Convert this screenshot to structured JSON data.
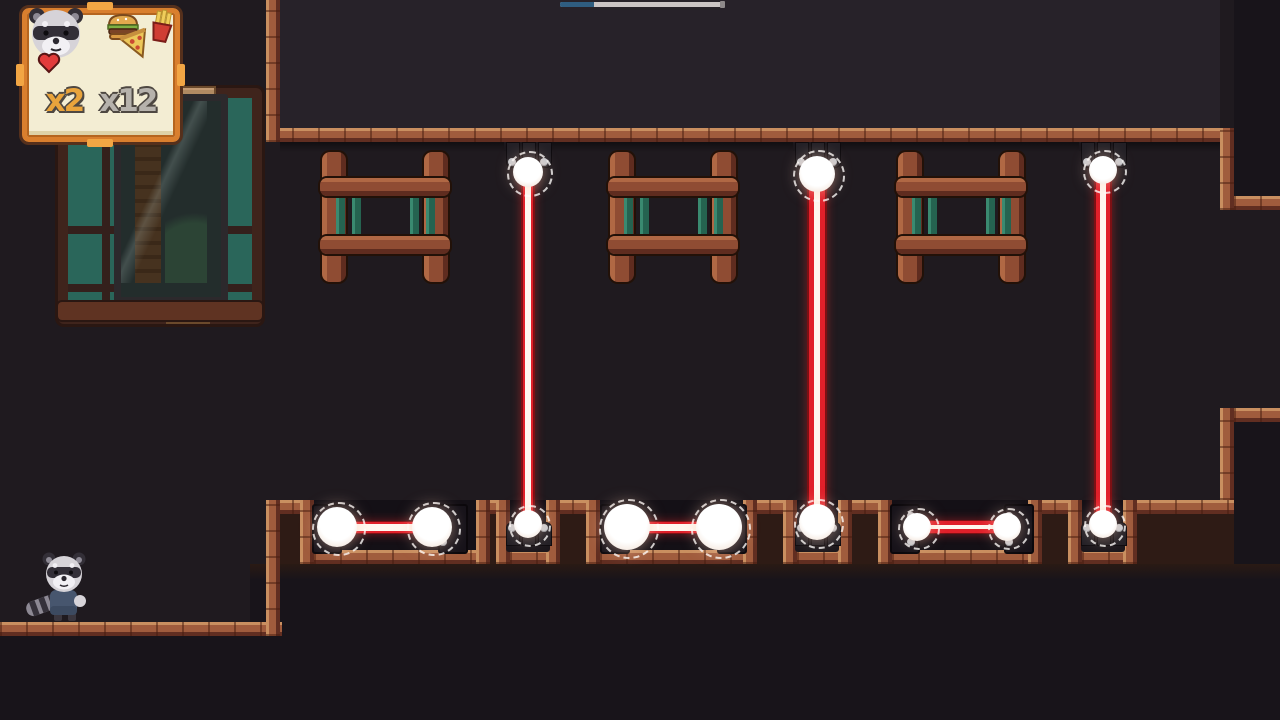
{
  "hud": {
    "lives": {
      "label": "x2",
      "color": "#e9a43c",
      "icons": [
        "raccoon-avatar",
        "heart-icon"
      ]
    },
    "food": {
      "label": "x12",
      "color": "#b6b2ac",
      "icons": [
        "burger-icon",
        "pizza-icon",
        "fries-icon"
      ]
    },
    "panel": {
      "fill": "#f3edd3",
      "border": "#d97f2e",
      "outline": "#55301c",
      "accent": "#f2a644"
    }
  },
  "progress": {
    "pct": 21,
    "fill_color": "#2f5d80",
    "track_color": "#cbc5c5"
  },
  "palette": {
    "bg_room": "#1f1a1f",
    "bg_upper": "#272229",
    "bg_outside": "#18141a",
    "floor_glow": "#2a1a14",
    "plateau": "#2e1b15",
    "pit": "#141016",
    "metal": "#1b171c",
    "stud_cap": "#c9ccd1",
    "laser_dark": "#7c1014",
    "laser_red": "#e0202a",
    "laser_core": "#fff7ef",
    "orb": "#ffffff",
    "teal": "#2a665a",
    "brick": "#a05c3d"
  },
  "scene": {
    "ceiling_y": 128,
    "floor_y": 500,
    "pit_floor_y": 550,
    "lower_floor_y": 622,
    "windows": [
      {
        "x": 322
      },
      {
        "x": 610
      },
      {
        "x": 898
      }
    ],
    "plateaus": [
      [
        266,
        314
      ],
      [
        476,
        510
      ],
      [
        546,
        600
      ],
      [
        743,
        797
      ],
      [
        838,
        892
      ],
      [
        1028,
        1082
      ],
      [
        1123,
        1234
      ]
    ],
    "pits": [
      [
        314,
        476
      ],
      [
        510,
        546
      ],
      [
        600,
        743
      ],
      [
        797,
        838
      ],
      [
        892,
        1028
      ],
      [
        1082,
        1123
      ]
    ],
    "lasers": [
      {
        "x": 528,
        "ey": 172,
        "er": 15,
        "ry": 524,
        "rr": 14,
        "beam": {
          "edge": 2,
          "red": 2,
          "core": 6
        }
      },
      {
        "x": 817,
        "ey": 174,
        "er": 18,
        "ry": 522,
        "rr": 18,
        "beam": {
          "edge": 2,
          "red": 5,
          "core": 6
        }
      },
      {
        "x": 1103,
        "ey": 170,
        "er": 14,
        "ry": 524,
        "rr": 14,
        "beam": {
          "edge": 2,
          "red": 4,
          "core": 6
        }
      }
    ],
    "orb_pairs": [
      {
        "orbs": [
          337,
          432
        ],
        "r": 20,
        "beam": {
          "edge": 1,
          "red": 2,
          "core": 7
        },
        "brackets": [
          312,
          438
        ]
      },
      {
        "orbs": [
          627,
          719
        ],
        "r": 23,
        "beam": {
          "edge": 1,
          "red": 2,
          "core": 7
        },
        "brackets": [
          600,
          717
        ]
      },
      {
        "orbs": [
          917,
          1007
        ],
        "r": 14,
        "beam": {
          "edge": 1,
          "red": 4,
          "core": 4
        },
        "brackets": [
          890,
          1004
        ]
      }
    ],
    "pair_beam_y": 527,
    "raccoon": {
      "x": 24,
      "y": 548
    }
  }
}
